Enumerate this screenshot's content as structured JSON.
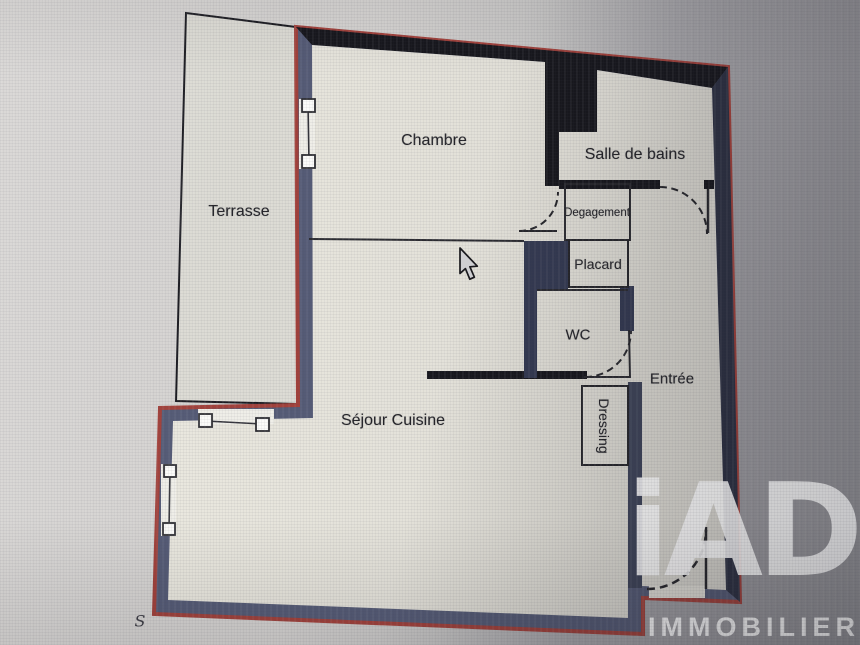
{
  "rooms": {
    "terrasse": {
      "label": "Terrasse"
    },
    "chambre": {
      "label": "Chambre"
    },
    "salle_de_bains": {
      "label": "Salle de bains"
    },
    "degagement": {
      "label": "Degagement"
    },
    "placard": {
      "label": "Placard"
    },
    "wc": {
      "label": "WC"
    },
    "entree": {
      "label": "Entrée"
    },
    "dressing": {
      "label": "Dressing"
    },
    "sejour_cuisine": {
      "label": "Séjour Cuisine"
    }
  },
  "annotations": {
    "compass_letter": "S"
  },
  "watermark": {
    "brand": "iAD",
    "subtitle": "IMMOBILIER"
  },
  "colors": {
    "outer_wall_outline": "#a2413b",
    "wall_slate": "#555b76",
    "wall_navy": "#343a52",
    "wall_divider": "#3e4459",
    "interior_wall_black": "#17171d",
    "floor_light": "#e9e7de",
    "floor_dark": "#d6d4cd",
    "background_left": "#d6d4d2",
    "background_right": "#97969b"
  }
}
